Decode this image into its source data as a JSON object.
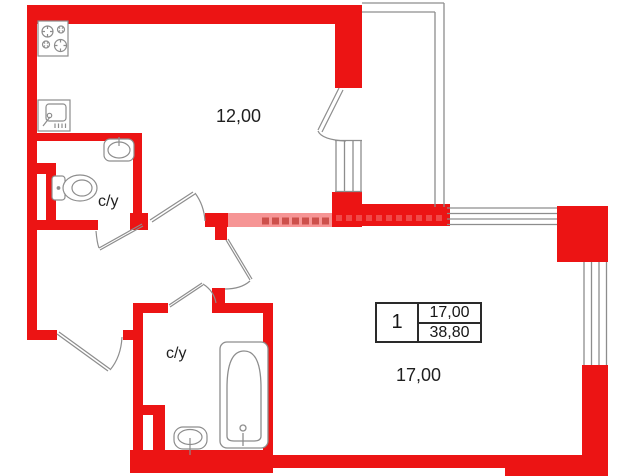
{
  "canvas": {
    "width": 635,
    "height": 476
  },
  "colors": {
    "wall_red": "#ec1414",
    "outline_gray": "#8d8d8d",
    "label_text": "#1f1f1f",
    "watermark_pink": "#f6bdbd",
    "table_border": "#2a2a2a",
    "background": "#ffffff"
  },
  "rooms": {
    "kitchen_living": {
      "area": "12,00"
    },
    "room_main": {
      "area": "17,00"
    },
    "bathroom_upper": {
      "label": "с/у"
    },
    "bathroom_lower": {
      "label": "с/у"
    }
  },
  "summary_table": {
    "rooms_count": "1",
    "living_area": "17,00",
    "total_area": "38,80"
  },
  "fixtures": {
    "kitchen": [
      "stove-icon",
      "kitchen-sink-icon"
    ],
    "bathroom_upper": [
      "wash-basin-icon",
      "toilet-icon"
    ],
    "bathroom_lower": [
      "bathtub-icon",
      "wash-basin-icon"
    ]
  }
}
